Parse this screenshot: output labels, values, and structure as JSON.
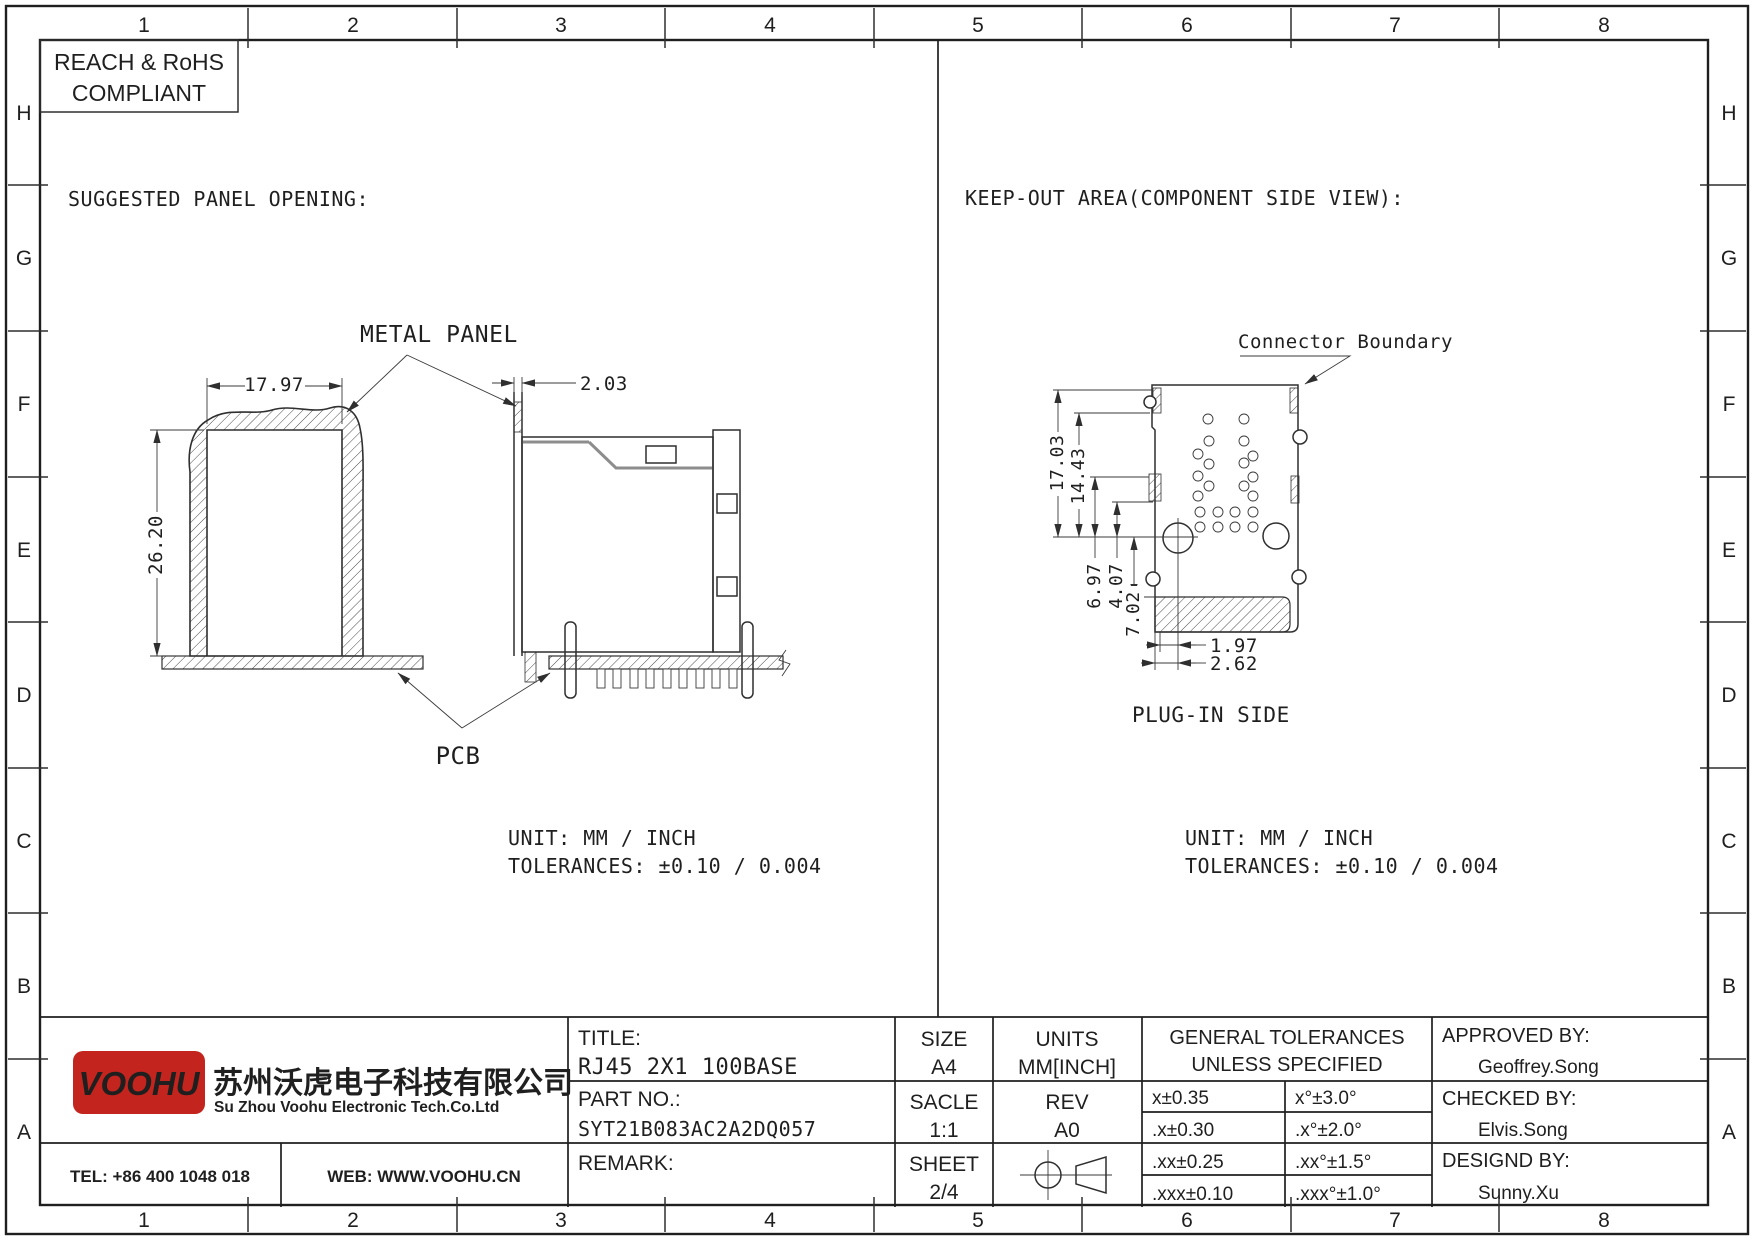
{
  "frame": {
    "cols": [
      "1",
      "2",
      "3",
      "4",
      "5",
      "6",
      "7",
      "8"
    ],
    "rows": [
      "H",
      "G",
      "F",
      "E",
      "D",
      "C",
      "B",
      "A"
    ]
  },
  "compliance": {
    "line1": "REACH & RoHS",
    "line2": "COMPLIANT"
  },
  "left_view": {
    "heading": "SUGGESTED PANEL OPENING:",
    "metal_panel_label": "METAL PANEL",
    "pcb_label": "PCB",
    "dim_width": "17.97",
    "dim_height": "26.20",
    "dim_thickness": "2.03",
    "unit_line": "UNIT: MM / INCH",
    "tolerance_line": "TOLERANCES: ±0.10 / 0.004"
  },
  "right_view": {
    "heading": "KEEP-OUT AREA(COMPONENT SIDE VIEW):",
    "boundary_label": "Connector Boundary",
    "plug_label": "PLUG-IN SIDE",
    "d_17_03": "17.03",
    "d_14_43": "14.43",
    "d_6_97": "6.97",
    "d_4_07": "4.07",
    "d_7_02": "7.02",
    "d_1_97": "1.97",
    "d_2_62": "2.62",
    "unit_line": "UNIT: MM / INCH",
    "tolerance_line": "TOLERANCES: ±0.10 / 0.004"
  },
  "title_block": {
    "title_label": "TITLE:",
    "title_value": "RJ45 2X1 100BASE",
    "part_label": "PART NO.:",
    "part_value": "SYT21B083AC2A2DQ057",
    "remark_label": "REMARK:",
    "size_label": "SIZE",
    "size_value": "A4",
    "scale_label": "SACLE",
    "scale_value": "1:1",
    "sheet_label": "SHEET",
    "sheet_value": "2/4",
    "units_label": "UNITS",
    "units_value": "MM[INCH]",
    "rev_label": "REV",
    "rev_value": "A0",
    "tol_header1": "GENERAL TOLERANCES",
    "tol_header2": "UNLESS SPECIFIED",
    "tolerances": [
      {
        "lin": "x±0.35",
        "ang": "x°±3.0°"
      },
      {
        "lin": ".x±0.30",
        "ang": ".x°±2.0°"
      },
      {
        "lin": ".xx±0.25",
        "ang": ".xx°±1.5°"
      },
      {
        "lin": ".xxx±0.10",
        "ang": ".xxx°±1.0°"
      }
    ],
    "approved_label": "APPROVED BY:",
    "approved_value": "Geoffrey.Song",
    "checked_label": "CHECKED BY:",
    "checked_value": "Elvis.Song",
    "designed_label": "DESIGND BY:",
    "designed_value": "Sunny.Xu"
  },
  "company": {
    "logo_text": "VOOHU",
    "name_cn": "苏州沃虎电子科技有限公司",
    "name_en": "Su Zhou Voohu Electronic Tech.Co.Ltd",
    "tel": "TEL: +86 400 1048 018",
    "web": "WEB: WWW.VOOHU.CN"
  },
  "palette": {
    "brand_red": "#c3251e",
    "web_blue": "#1b5494",
    "ink": "#1f1f1f"
  }
}
